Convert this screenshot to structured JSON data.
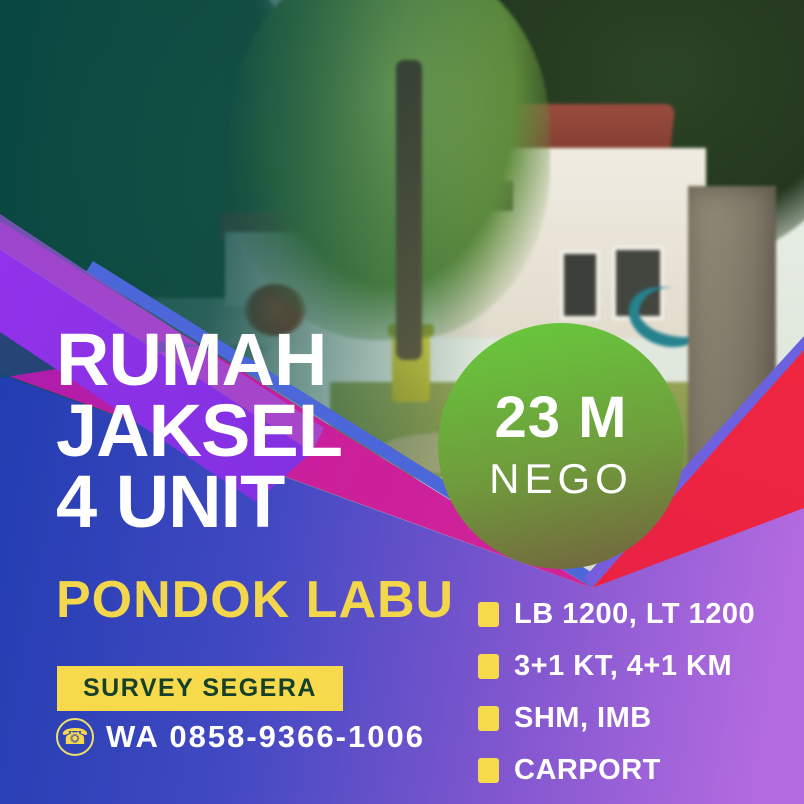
{
  "poster": {
    "headline_lines": [
      "RUMAH",
      "JAKSEL",
      "4 UNIT"
    ],
    "location": "PONDOK LABU",
    "cta_badge": "SURVEY SEGERA",
    "price_badge": {
      "amount": "23 M",
      "note": "NEGO"
    },
    "contact": {
      "glyph": "☎",
      "label": "WA 0858-9366-1006"
    },
    "features": [
      "LB 1200, LT 1200",
      "3+1 KT, 4+1 KM",
      "SHM, IMB",
      "CARPORT"
    ],
    "colors": {
      "accent_yellow": "#f7d94c",
      "deep_blue": "#2240b4",
      "purple_light": "#b46be0",
      "violet_band": "#8a2be2",
      "magenta_band": "#cb1f9c",
      "red_band": "#ef2440",
      "teal_overlay": "#0a4a46",
      "circle_green_top": "#68c53c",
      "circle_olive_bottom": "#73683e",
      "badge_text": "#17402b",
      "text_white": "#ffffff"
    }
  }
}
